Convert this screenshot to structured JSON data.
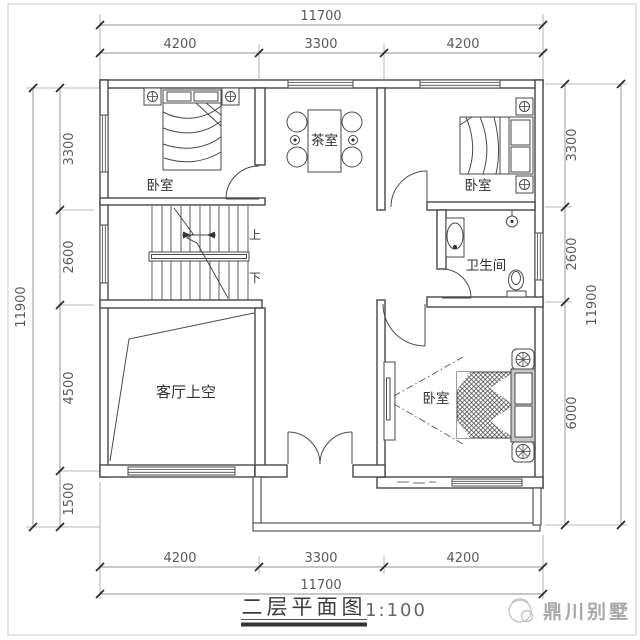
{
  "titleblock": {
    "title": "二层平面图",
    "scale": "1:100",
    "watermark": "鼎川别墅"
  },
  "labels": {
    "bedroom_tl": "卧室",
    "bedroom_tr": "卧室",
    "bedroom_br": "卧室",
    "tea_room": "茶室",
    "bathroom": "卫生间",
    "living_void": "客厅上空",
    "stairs_up": "上",
    "stairs_down": "下"
  },
  "dimensions": {
    "top": {
      "total": "11700",
      "segments": [
        "4200",
        "3300",
        "4200"
      ]
    },
    "bottom": {
      "total": "11700",
      "segments": [
        "4200",
        "3300",
        "4200"
      ]
    },
    "left": {
      "total": "11900",
      "segments": [
        "3300",
        "2600",
        "4500",
        "1500"
      ]
    },
    "right": {
      "total": "11900",
      "segments": [
        "3300",
        "2600",
        "6000"
      ]
    }
  },
  "colors": {
    "plan_line": "#474747",
    "dimension_text": "#5a5a5a",
    "watermark_gray": "#a8a8a8"
  }
}
